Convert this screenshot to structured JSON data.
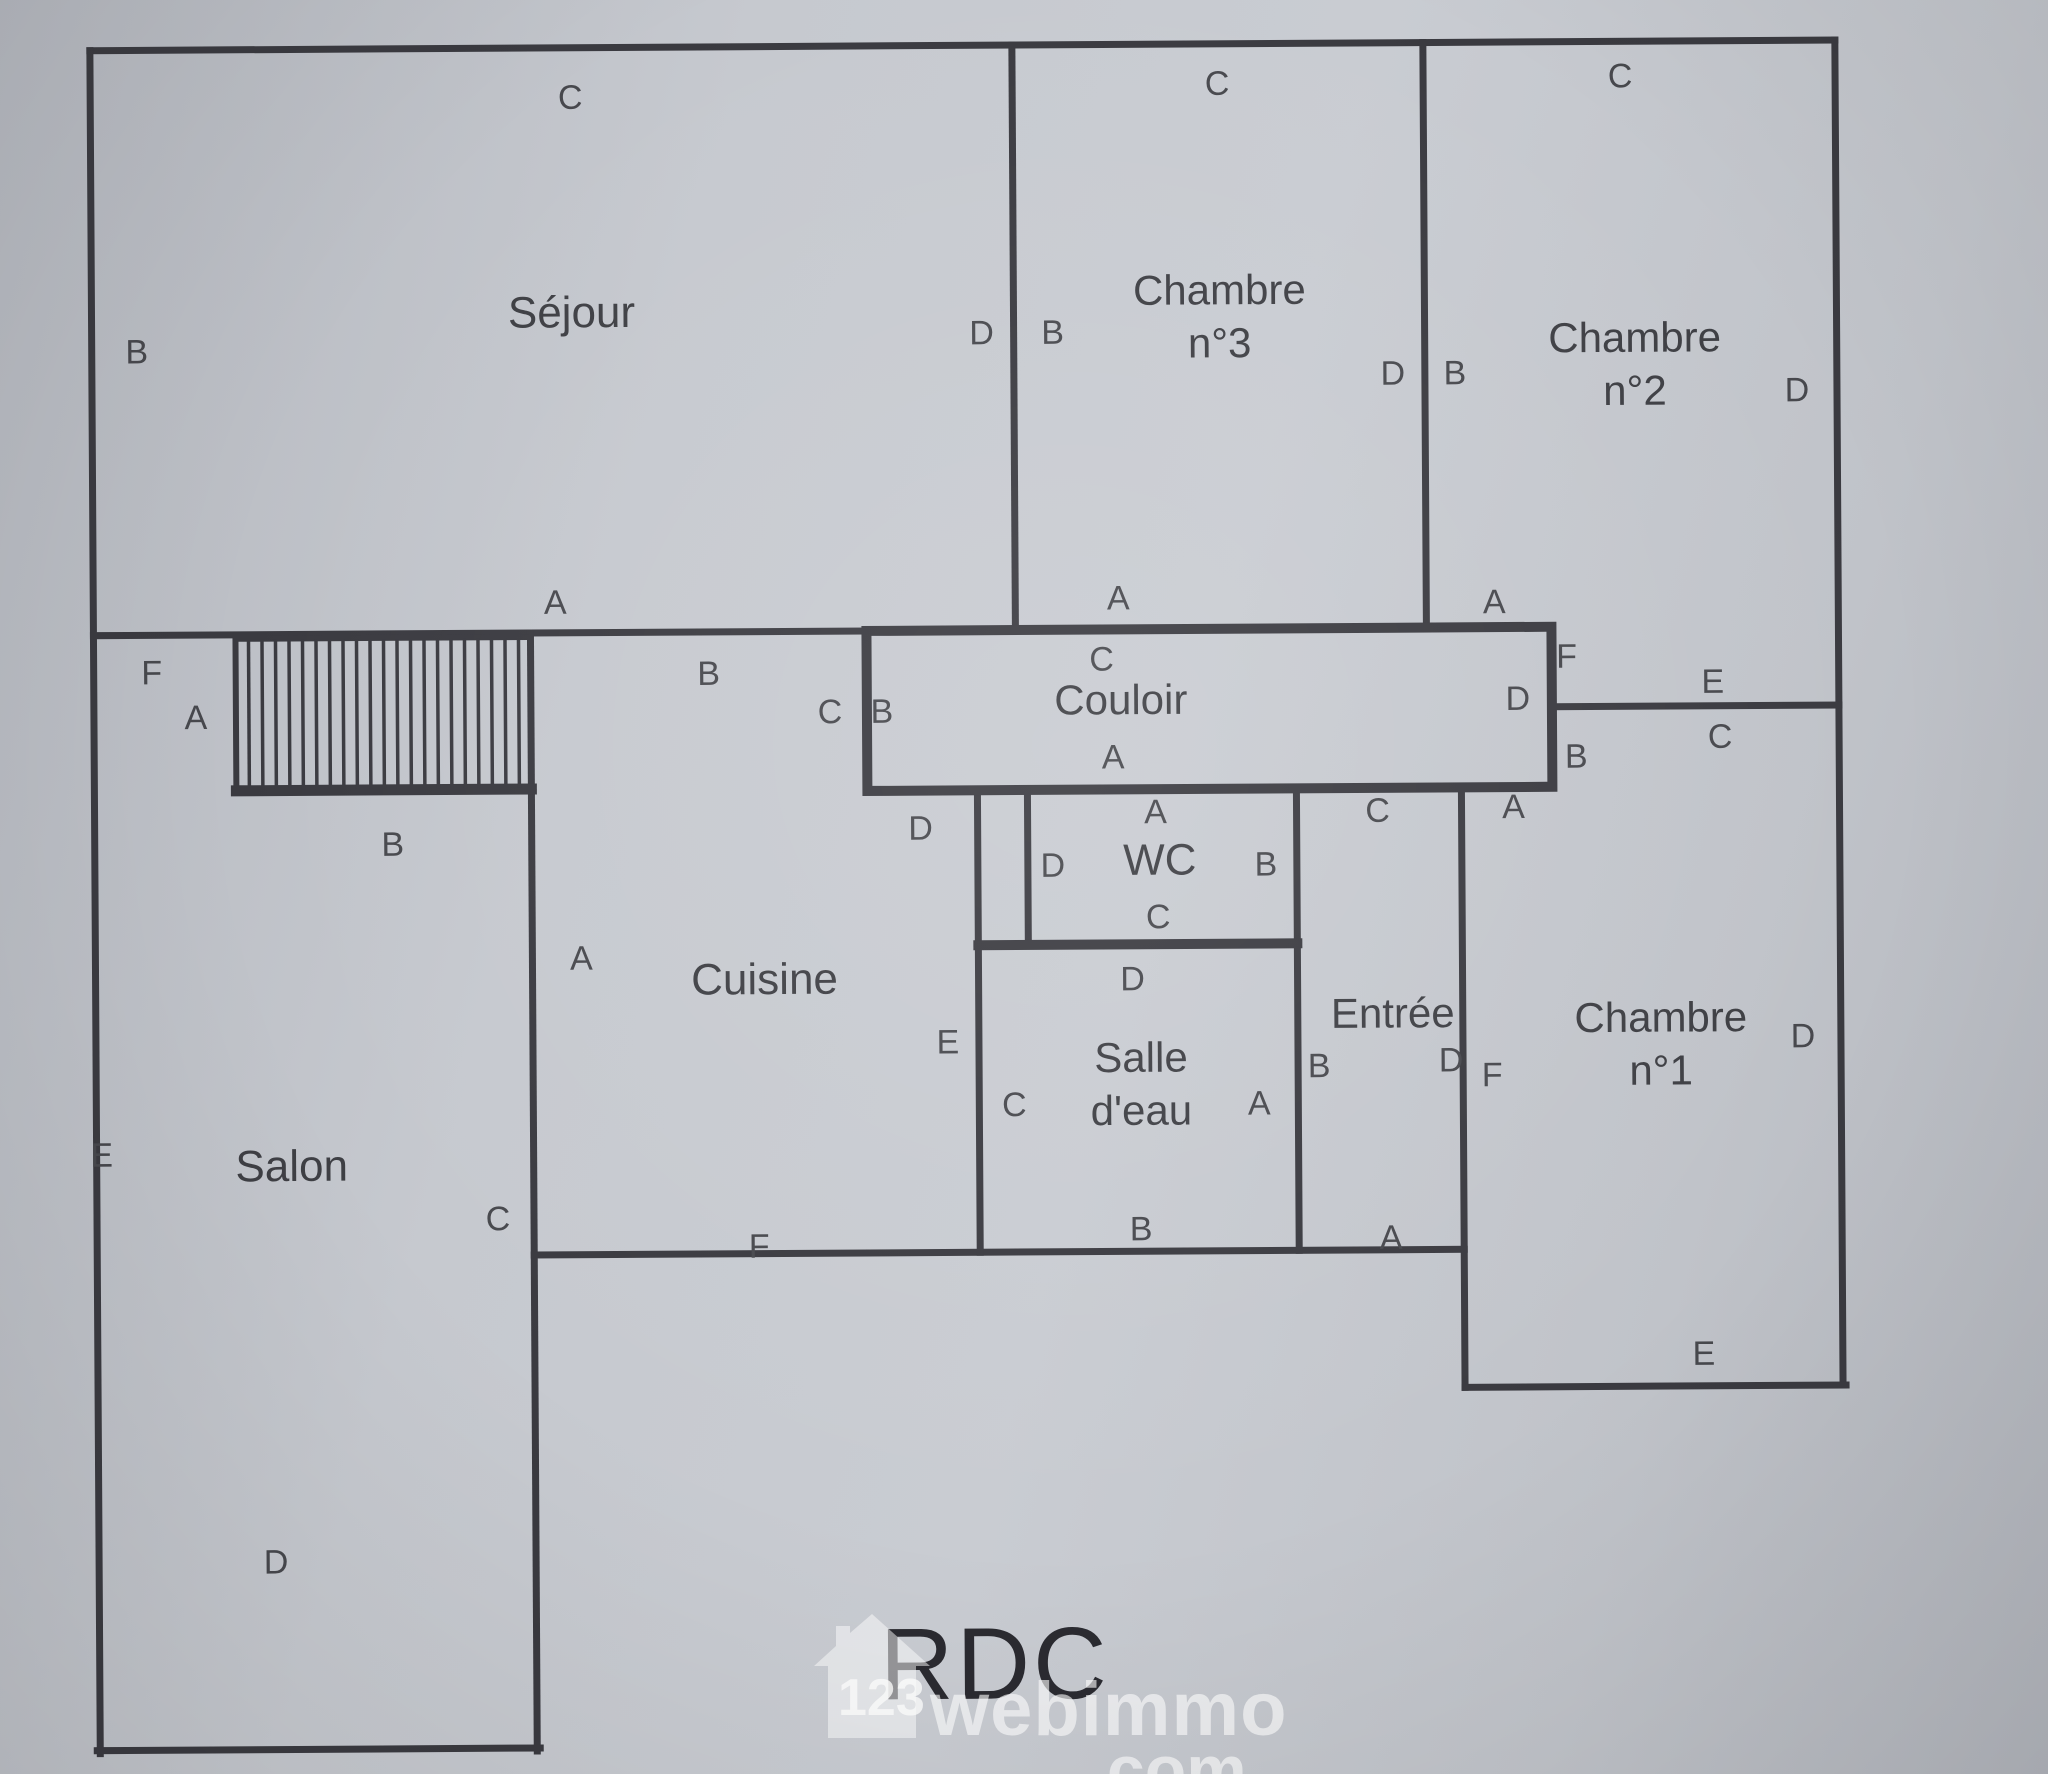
{
  "page": {
    "floor_label": "RDC"
  },
  "watermark": {
    "number": "123",
    "brand": "webimmo",
    "suffix": ".com"
  },
  "colors": {
    "wall": "#3a3a40",
    "label": "#47484d",
    "paper": "#c2c5cb",
    "watermark": "rgba(255,255,255,0.62)"
  },
  "plan": {
    "rooms": [
      {
        "name": "Séjour",
        "x": 575,
        "y": 310,
        "size": 44
      },
      {
        "name": "Chambre\nn°3",
        "x": 1223,
        "y": 318,
        "size": 42
      },
      {
        "name": "Chambre\nn°2",
        "x": 1638,
        "y": 368,
        "size": 42
      },
      {
        "name": "Couloir",
        "x": 1122,
        "y": 701,
        "size": 42
      },
      {
        "name": "WC",
        "x": 1160,
        "y": 861,
        "size": 44
      },
      {
        "name": "Cuisine",
        "x": 764,
        "y": 978,
        "size": 44
      },
      {
        "name": "Salle\nd'eau",
        "x": 1140,
        "y": 1085,
        "size": 42
      },
      {
        "name": "Entrée",
        "x": 1392,
        "y": 1016,
        "size": 42
      },
      {
        "name": "Chambre\nn°1",
        "x": 1660,
        "y": 1048,
        "size": 42
      },
      {
        "name": "Salon",
        "x": 290,
        "y": 1162,
        "size": 44
      }
    ],
    "wall_labels": [
      {
        "t": "C",
        "x": 575,
        "y": 95
      },
      {
        "t": "C",
        "x": 1222,
        "y": 85
      },
      {
        "t": "C",
        "x": 1625,
        "y": 80
      },
      {
        "t": "B",
        "x": 140,
        "y": 347
      },
      {
        "t": "D",
        "x": 985,
        "y": 333
      },
      {
        "t": "B",
        "x": 1056,
        "y": 333
      },
      {
        "t": "D",
        "x": 1396,
        "y": 376
      },
      {
        "t": "B",
        "x": 1458,
        "y": 376
      },
      {
        "t": "D",
        "x": 1800,
        "y": 395
      },
      {
        "t": "A",
        "x": 557,
        "y": 600
      },
      {
        "t": "A",
        "x": 1120,
        "y": 599
      },
      {
        "t": "A",
        "x": 1496,
        "y": 605
      },
      {
        "t": "F",
        "x": 153,
        "y": 668
      },
      {
        "t": "A",
        "x": 197,
        "y": 713
      },
      {
        "t": "B",
        "x": 393,
        "y": 841
      },
      {
        "t": "B",
        "x": 710,
        "y": 672
      },
      {
        "t": "C",
        "x": 831,
        "y": 711
      },
      {
        "t": "B",
        "x": 883,
        "y": 711
      },
      {
        "t": "C",
        "x": 1103,
        "y": 660
      },
      {
        "t": "A",
        "x": 1114,
        "y": 758
      },
      {
        "t": "D",
        "x": 1519,
        "y": 702
      },
      {
        "t": "F",
        "x": 1568,
        "y": 660
      },
      {
        "t": "B",
        "x": 1577,
        "y": 760
      },
      {
        "t": "E",
        "x": 1714,
        "y": 686
      },
      {
        "t": "C",
        "x": 1721,
        "y": 741
      },
      {
        "t": "A",
        "x": 1514,
        "y": 810
      },
      {
        "t": "D",
        "x": 921,
        "y": 828
      },
      {
        "t": "A",
        "x": 581,
        "y": 956
      },
      {
        "t": "E",
        "x": 947,
        "y": 1042
      },
      {
        "t": "F",
        "x": 757,
        "y": 1245
      },
      {
        "t": "C",
        "x": 496,
        "y": 1216
      },
      {
        "t": "A",
        "x": 1156,
        "y": 813
      },
      {
        "t": "D",
        "x": 1053,
        "y": 866
      },
      {
        "t": "B",
        "x": 1266,
        "y": 866
      },
      {
        "t": "C",
        "x": 1158,
        "y": 918
      },
      {
        "t": "D",
        "x": 1132,
        "y": 980
      },
      {
        "t": "C",
        "x": 1013,
        "y": 1105
      },
      {
        "t": "A",
        "x": 1258,
        "y": 1105
      },
      {
        "t": "B",
        "x": 1139,
        "y": 1230
      },
      {
        "t": "C",
        "x": 1378,
        "y": 813
      },
      {
        "t": "B",
        "x": 1318,
        "y": 1068
      },
      {
        "t": "D",
        "x": 1450,
        "y": 1063
      },
      {
        "t": "A",
        "x": 1389,
        "y": 1240
      },
      {
        "t": "D",
        "x": 1802,
        "y": 1041
      },
      {
        "t": "E",
        "x": 1701,
        "y": 1358
      },
      {
        "t": "F",
        "x": 1491,
        "y": 1078
      },
      {
        "t": "E",
        "x": 100,
        "y": 1150
      },
      {
        "t": "D",
        "x": 272,
        "y": 1558
      }
    ]
  }
}
